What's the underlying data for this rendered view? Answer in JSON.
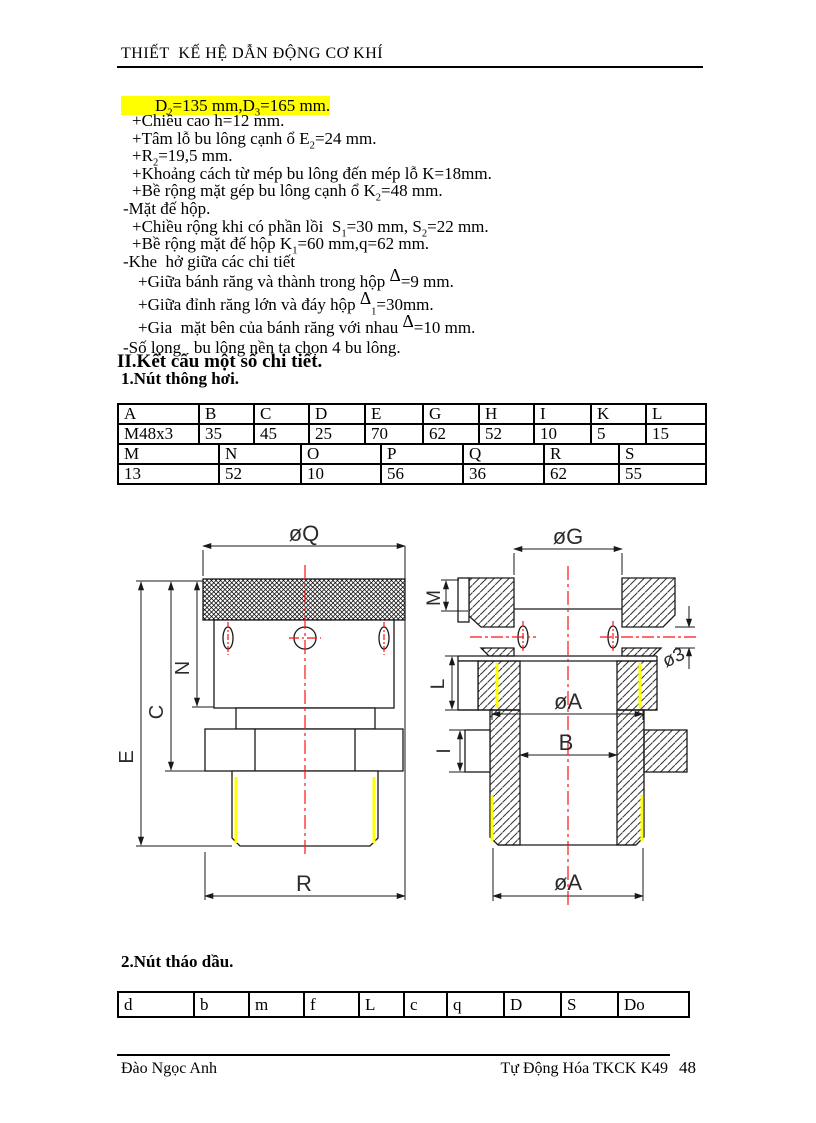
{
  "page": {
    "header": {
      "title": "THIẾT  KẾ HỆ DẪN ĐỘNG CƠ KHÍ"
    },
    "footer": {
      "author": "Đào Ngọc Anh",
      "course": "Tự Động  Hóa TKCK K49",
      "page_number": "48"
    }
  },
  "content": {
    "highlight_line": "        D~2~=135 mm,D~3~=165 mm.",
    "highlight_color": "#ffff00",
    "lines": [
      {
        "text": "+Chiều cao h=12 mm."
      },
      {
        "text": "+Tâm lỗ bu lông cạnh ổ E~2~=24 mm."
      },
      {
        "text": "+R~2~=19,5 mm."
      },
      {
        "text": "+Khoảng cách từ mép bu lông đến mép lỗ K=18mm."
      },
      {
        "text": "+Bề rộng mặt gép bu lông cạnh ổ K~2~=48 mm."
      },
      {
        "text": "-Mặt đế hộp."
      },
      {
        "text": "+Chiều rộng khi có phần lồi  S~1~=30 mm, S~2~=22 mm."
      },
      {
        "text": "+Bề rộng mặt đế hộp K~1~=60 mm,q=62 mm."
      },
      {
        "text": "-Khe  hở giữa các chi tiết"
      },
      {
        "text": "+Giữa bánh răng và thành trong hộp ^Δ^=9 mm."
      },
      {
        "text": "+Giữa đỉnh răng lớn và đáy hộp ^Δ^~1~=30mm."
      },
      {
        "text": "+Gia  mặt bên của bánh răng với nhau ^Δ^=10 mm."
      },
      {
        "text": "-Số lọng   bu lông nền ta chọn 4 bu lông."
      }
    ],
    "section2_title": "II.Kết cấu một số chi tiết.",
    "sub1_title": "1.Nút thông hơi.",
    "sub2_title": "2.Nút tháo dầu."
  },
  "table1": {
    "row1": [
      "A",
      "B",
      "C",
      "D",
      "E",
      "G",
      "H",
      "I",
      "K",
      "L"
    ],
    "row2": [
      "M48x3",
      "35",
      "45",
      "25",
      "70",
      "62",
      "52",
      "10",
      "5",
      "15"
    ],
    "row3": [
      "M",
      "N",
      "O",
      "P",
      "Q",
      "R",
      "S"
    ],
    "row4": [
      "13",
      "52",
      "10",
      "56",
      "36",
      "62",
      "55"
    ]
  },
  "table2": {
    "headers": [
      "d",
      "b",
      "m",
      "f",
      "L",
      "c",
      "q",
      "D",
      "S",
      "Do"
    ]
  },
  "drawing": {
    "left_view": {
      "labels": {
        "oq": "øQ",
        "e": "E",
        "c": "C",
        "n": "N",
        "r": "R"
      }
    },
    "right_view": {
      "labels": {
        "og": "øG",
        "m": "M",
        "o3": "ø3",
        "l": "L",
        "i": "I",
        "oa_mid": "øA",
        "b": "B",
        "oa_bottom": "øA"
      }
    },
    "colors": {
      "centerline": "#ff1111",
      "thread_highlight": "#ffff00"
    }
  }
}
